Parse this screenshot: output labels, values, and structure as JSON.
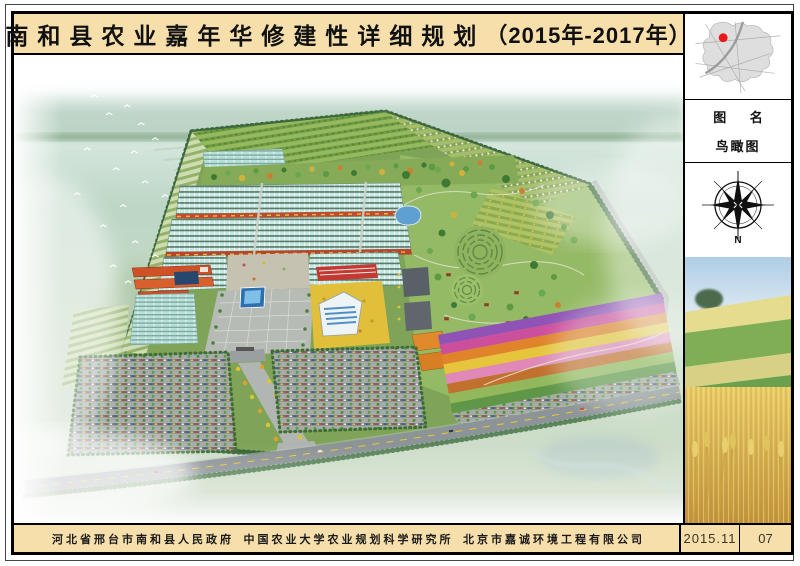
{
  "title": {
    "main": "南和县农业嘉年华修建性详细规划",
    "period": "（2015年-2017年）"
  },
  "sidebar": {
    "map_caption_label": "图 名",
    "drawing_name": "鸟瞰图",
    "compass_north": "N"
  },
  "footer": {
    "organizations": [
      "河北省邢台市南和县人民政府",
      "中国农业大学农业规划科学研究所",
      "北京市嘉诚环境工程有限公司"
    ],
    "date": "2015.11",
    "page": "07"
  },
  "colors": {
    "paper_tan": "#f6dfab",
    "frame_black": "#000000",
    "locator_dot_red": "#e81818",
    "greenhouse_teal": "#c6e9e4",
    "site_green": "#7fa457",
    "fountain_blue": "#3f86c0",
    "road_gray": "#8d9498",
    "wheat_gold": "#d9ae54",
    "flower_strip_colors": [
      "#8f53b5",
      "#cc4f9e",
      "#e0832a",
      "#e6c53c",
      "#e089b8",
      "#c2702e",
      "#93b85c",
      "#5f9648"
    ]
  }
}
